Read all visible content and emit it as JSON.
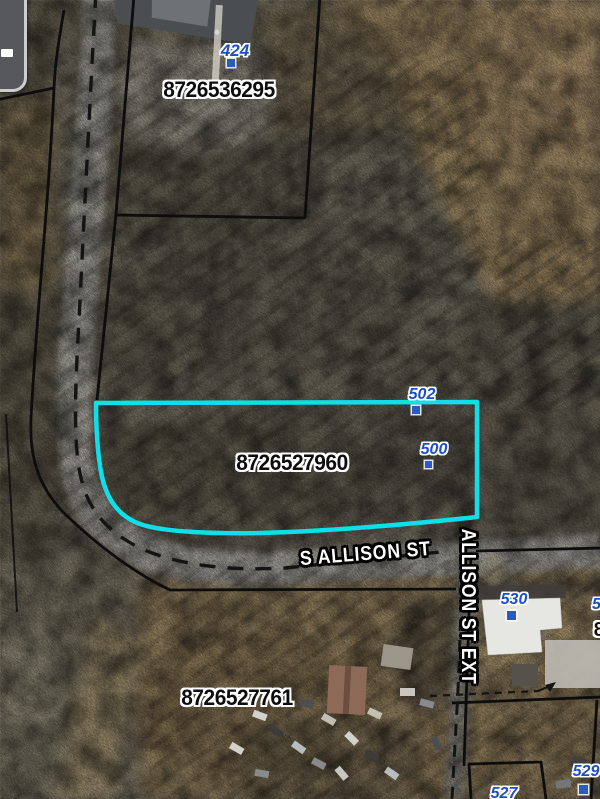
{
  "controls": {
    "zoom_out_icon": "minus"
  },
  "parcel_labels": {
    "top_parcel_pin": "8726536295",
    "highlighted_parcel_pin": "8726527960",
    "bottom_parcel_pin": "8726527761",
    "right_edge_partial_parcel": "8"
  },
  "address_labels": {
    "house_424": "424",
    "house_502": "502",
    "house_500": "500",
    "house_530": "530",
    "house_529": "529",
    "house_527": "527",
    "right_edge_partial_address": "5"
  },
  "street_labels": {
    "main_street": "S ALLISON ST",
    "extension_street": "ALLISON ST EXT"
  },
  "colors": {
    "highlighted_parcel_outline": "#10DEE8",
    "address_label_blue": "#1D4FC4",
    "parcel_boundary": "#0D0D0D",
    "street_label_fill": "#FFFFFF",
    "street_label_outline": "#000000"
  }
}
